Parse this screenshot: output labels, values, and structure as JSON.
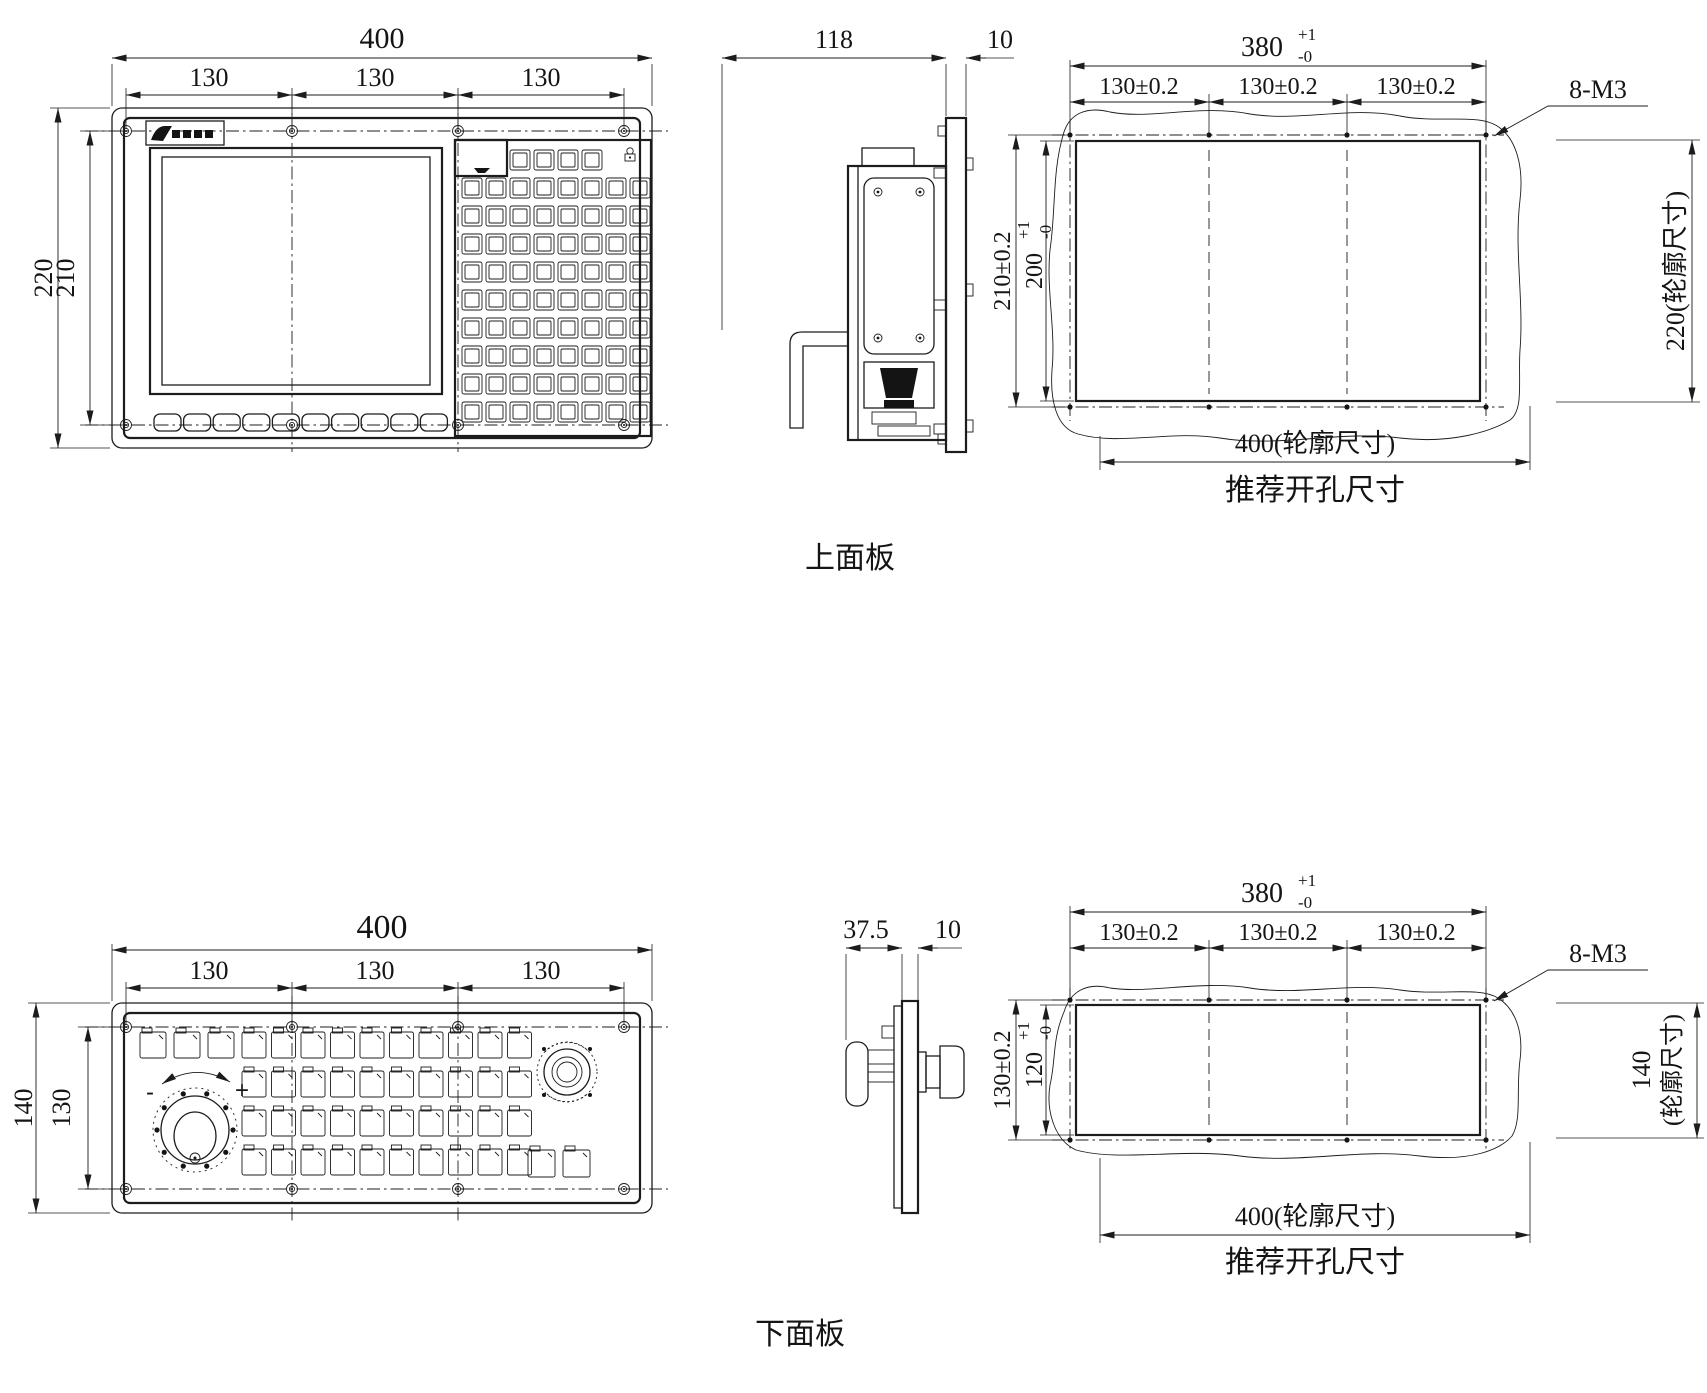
{
  "upper": {
    "label": "上面板",
    "front": {
      "overall_width": "400",
      "pitch1": "130",
      "pitch2": "130",
      "pitch3": "130",
      "overall_height": "220",
      "hole_height": "210"
    },
    "side": {
      "depth": "118",
      "panel_thickness": "10"
    },
    "cutout": {
      "hole_span": "380",
      "hole_span_tol_plus": "+1",
      "hole_span_tol_minus": "-0",
      "pitch1": "130±0.2",
      "pitch2": "130±0.2",
      "pitch3": "130±0.2",
      "screw_spec": "8-M3",
      "hole_height": "210±0.2",
      "opening_height": "200",
      "opening_tol_plus": "+1",
      "opening_tol_minus": "-0",
      "outline_height": "220(轮廓尺寸)",
      "outline_width": "400(轮廓尺寸)",
      "caption": "推荐开孔尺寸"
    }
  },
  "lower": {
    "label": "下面板",
    "front": {
      "overall_width": "400",
      "pitch1": "130",
      "pitch2": "130",
      "pitch3": "130",
      "overall_height": "140",
      "hole_height": "130",
      "handwheel_minus": "-",
      "handwheel_plus": "+"
    },
    "side": {
      "depth": "37.5",
      "panel_thickness": "10"
    },
    "cutout": {
      "hole_span": "380",
      "hole_span_tol_plus": "+1",
      "hole_span_tol_minus": "-0",
      "pitch1": "130±0.2",
      "pitch2": "130±0.2",
      "pitch3": "130±0.2",
      "screw_spec": "8-M3",
      "hole_height": "130±0.2",
      "opening_height": "120",
      "opening_tol_plus": "+1",
      "opening_tol_minus": "-0",
      "outline_height_value": "140",
      "outline_height_suffix": "(轮廓尺寸)",
      "outline_width": "400(轮廓尺寸)",
      "caption": "推荐开孔尺寸"
    }
  }
}
